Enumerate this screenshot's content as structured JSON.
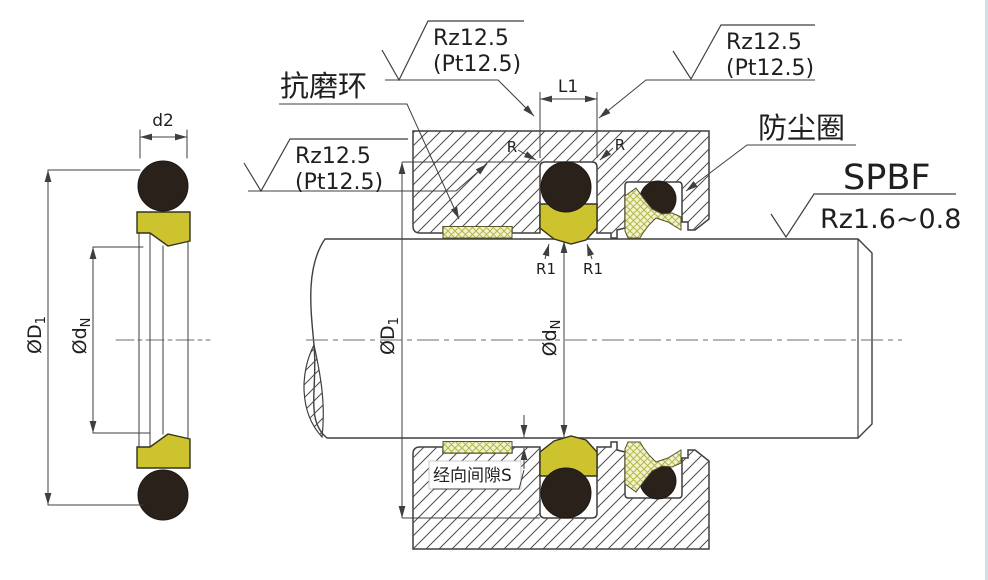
{
  "drawing": {
    "title_labels": {
      "wear_ring": "抗磨环",
      "dust_seal": "防尘圈",
      "seal_model": "SPBF",
      "rod_surface_roughness": "Rz1.6~0.8",
      "radial_clearance": "经向间隙S"
    },
    "surface_callout": {
      "line1": "Rz12.5",
      "line2": "(Pt12.5)"
    },
    "dimensions": {
      "d2": "d2",
      "L1": "L1",
      "R": "R",
      "R1": "R1",
      "D1": {
        "main": "ØD",
        "sub": "1"
      },
      "dN": {
        "main": "Ød",
        "sub": "N"
      }
    },
    "colors": {
      "line": "#3f3f3f",
      "seal_yellow": "#cdc32e",
      "ring_black": "#2a211b",
      "crosshatch_bg": "#f2f2cf",
      "crosshatch_line": "#b3b845",
      "text": "#1f1f1f",
      "background": "#ffffff"
    }
  }
}
